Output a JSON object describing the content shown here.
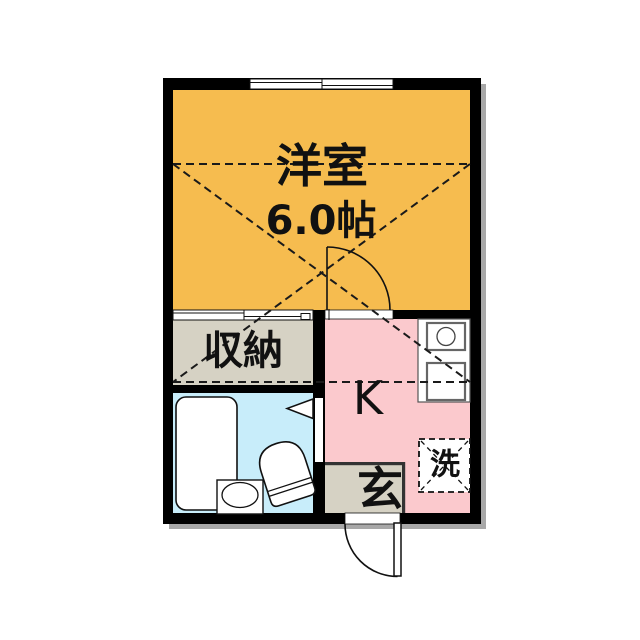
{
  "plan_title": "1K apartment floor plan",
  "rooms": {
    "western": {
      "label": "洋室",
      "size": "6.0帖"
    },
    "closet": {
      "label": "収納"
    },
    "kitchen": {
      "label": "K"
    },
    "entrance": {
      "label": "玄"
    },
    "laundry": {
      "label": "洗"
    }
  },
  "colors": {
    "western": "#F6BC4F",
    "closet": "#D6D2C4",
    "kitchen": "#FBC9CD",
    "bathroom": "#C8EDFA",
    "entrance": "#D6D2C4",
    "wall": "#000000",
    "shadow": "#A8A8A8",
    "fixture_stroke": "#111111"
  }
}
